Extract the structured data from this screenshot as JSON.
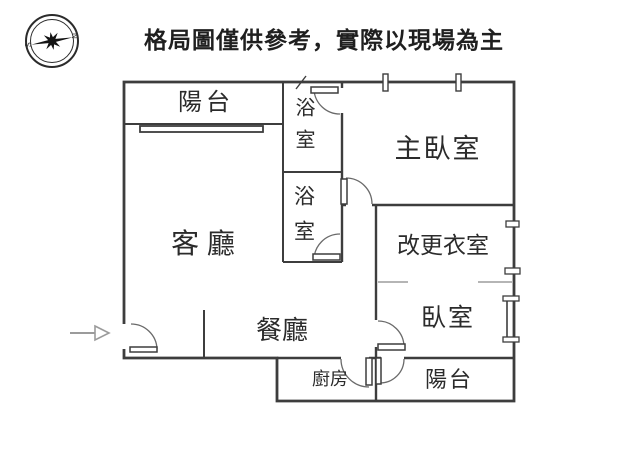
{
  "header": {
    "disclaimer": "格局圖僅供參考，實際以現場為主"
  },
  "compass": {
    "north_letter": "N",
    "south_letter": "S"
  },
  "rooms": {
    "balcony_top": {
      "label": "陽台"
    },
    "bath_upper": {
      "label": "浴室"
    },
    "bath_lower": {
      "label": "浴室"
    },
    "master_bedroom": {
      "label": "主臥室"
    },
    "dressing_room": {
      "label": "改更衣室"
    },
    "living_room": {
      "label": "客 廳"
    },
    "dining_room": {
      "label": "餐廳"
    },
    "bedroom": {
      "label": "臥室"
    },
    "kitchen": {
      "label": "廚房"
    },
    "balcony_bottom": {
      "label": "陽台"
    }
  },
  "colors": {
    "wall": "#3d3d3d",
    "door_arc": "#6a6a6a",
    "open_boundary": "#b5b5b5",
    "arrow": "#9b9b9b",
    "background": "#ffffff"
  }
}
